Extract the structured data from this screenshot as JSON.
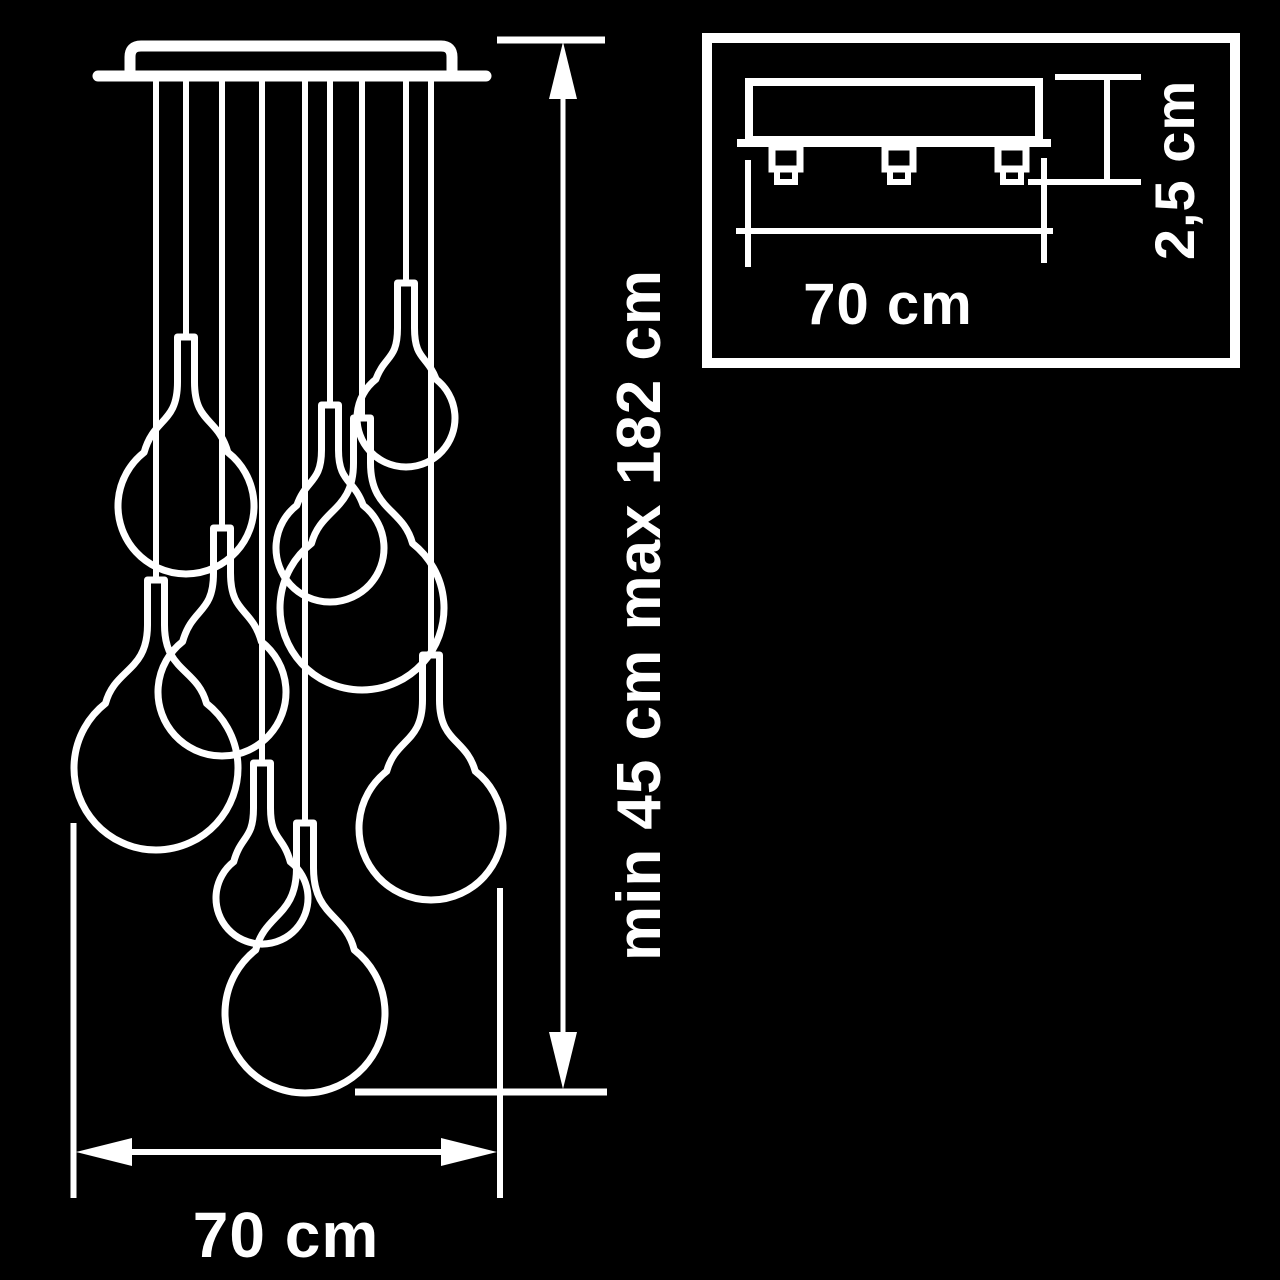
{
  "colors": {
    "background": "#000000",
    "line": "#ffffff"
  },
  "main_view": {
    "pendant_count": 9,
    "height_label": "min 45 cm max 182 cm",
    "width_label": "70 cm"
  },
  "inset_view": {
    "width_label": "70 cm",
    "thickness_label": "2,5 cm"
  }
}
